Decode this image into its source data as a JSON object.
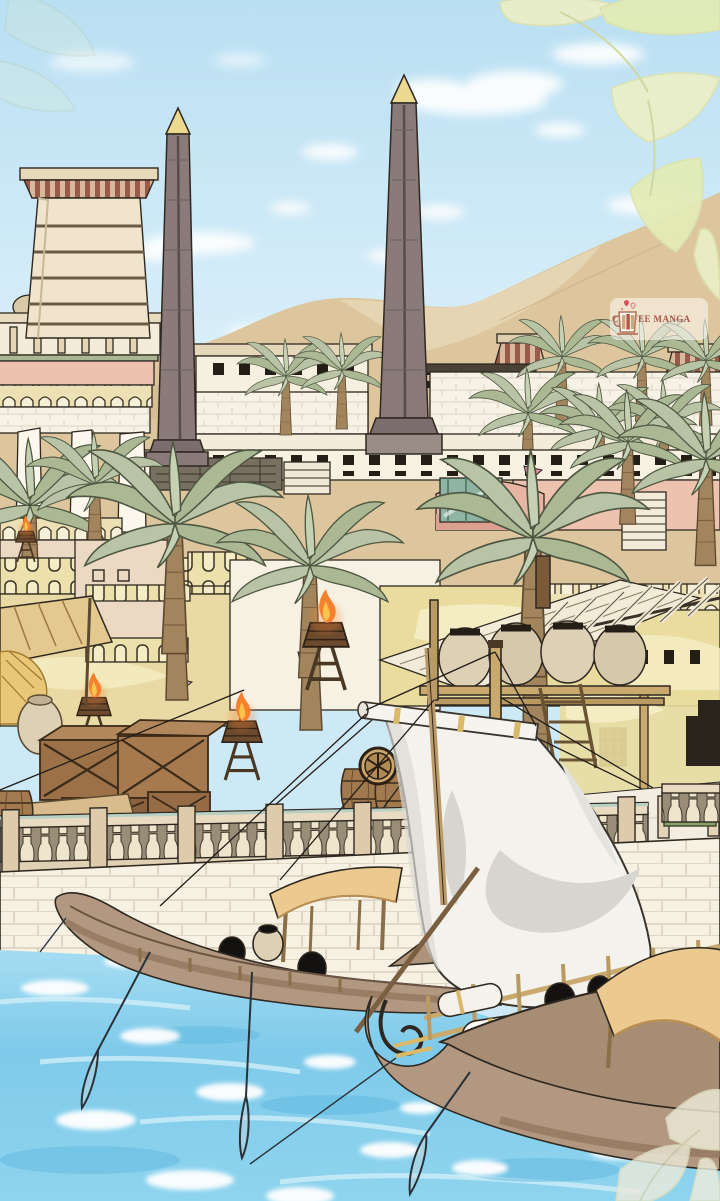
{
  "watermark": {
    "label": "COFFEE MANGA",
    "icon": "coffee-cup-with-hearts-icon"
  },
  "scene": {
    "description": "Manga-style illustration of an ancient Egyptian harbor city: obelisks and a pylon tower above terraced temple walls with palm trees, a market quay with crates, barrels and torch braziers, a stone balustrade, and sailing cargo boats on turquoise river water",
    "elements": [
      "sky",
      "clouds",
      "foliage-overlay",
      "sand-dunes",
      "pylon-tower",
      "obelisk-left",
      "obelisk-right",
      "colonnade-building",
      "temple-terraces",
      "palm-trees",
      "torch-braziers",
      "market-awning",
      "thatch-pile",
      "clay-pots",
      "wooden-crates",
      "barrels",
      "cart-wheels",
      "pink-pennants",
      "pergola",
      "amphora-rack",
      "ladder",
      "stone-balustrade",
      "quay-pavement",
      "mooring-bollard",
      "hedge",
      "quay-wall",
      "river-water",
      "foam",
      "main-sail",
      "mast",
      "rigging-ropes",
      "cargo-boat-near",
      "cargo-boat-far",
      "boat-canopies",
      "cargo-bundles",
      "cargo-jars",
      "wicker-baskets",
      "oars"
    ]
  },
  "palette": {
    "sky_top": "#bfe2f3",
    "sky_low": "#e6f4f9",
    "cloud": "#ffffff",
    "dune": "#ddc69e",
    "dune_light": "#e9d8b6",
    "stone_white": "#f6f1e3",
    "cream_wall": "#efe3c8",
    "yellow_wall": "#e9dc9e",
    "pink_building": "#edc2ae",
    "stripe_red": "#9a5a48",
    "palm_frond": "#b6c2a4",
    "palm_trunk": "#a2855c",
    "wood_dark": "#8a6240",
    "hull": "#b29880",
    "sail": "#f4f2ec",
    "sail_shadow": "#d6d5cf",
    "canopy": "#ecc98e",
    "flame": "#f58030",
    "gold": "#e6d28a",
    "water": "#85cfec",
    "foam": "#ffffff",
    "outline": "#2e2820",
    "watermark_text": "#a8544a"
  }
}
